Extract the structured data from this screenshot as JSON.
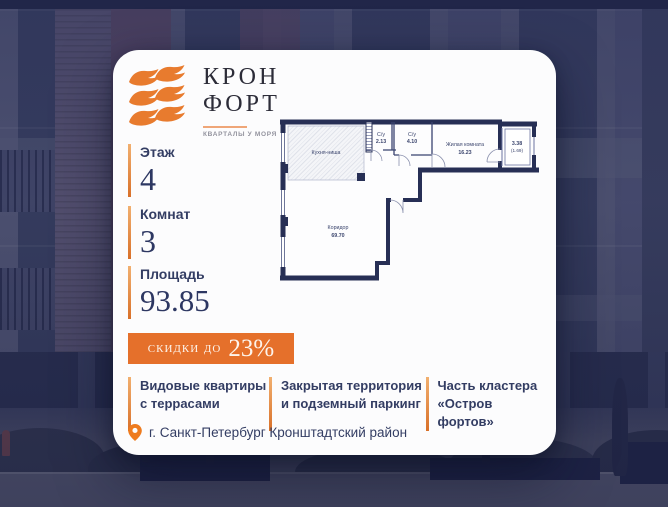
{
  "logo": {
    "title_line1": "КРОН",
    "title_line2": "ФОРТ",
    "subtitle": "КВАРТАЛЫ У МОРЯ",
    "icon": "waves-logo-icon"
  },
  "stats": [
    {
      "label": "Этаж",
      "value": "4"
    },
    {
      "label": "Комнат",
      "value": "3"
    },
    {
      "label": "Площадь",
      "value": "93.85"
    }
  ],
  "discount": {
    "prefix": "скидки до",
    "value": "23%"
  },
  "features": [
    {
      "line1": "Видовые квартиры",
      "line2": "с террасами"
    },
    {
      "line1": "Закрытая территория",
      "line2": "и подземный паркинг"
    },
    {
      "line1": "Часть кластера",
      "line2": "«Остров фортов»"
    }
  ],
  "location": {
    "icon": "map-pin-icon",
    "text": "г. Санкт-Петербург Кронштадтский район"
  },
  "plan": {
    "kitchen_name": "Кухня-ниша",
    "wc1_name": "С/у",
    "wc1_area": "2.13",
    "wc2_name": "С/у",
    "wc2_area": "4.10",
    "living_name": "Жилая комната",
    "living_area": "16.23",
    "corridor_name": "Коридор",
    "corridor_area": "69.70",
    "balcony_area": "3.38",
    "balcony_area_reduced": "(1.69)"
  },
  "colors": {
    "accent_orange": "#e5702b",
    "navy_text": "#333d63",
    "plan_wall": "#272f55",
    "card_bg": "#fcfcfd",
    "bg_tint": "#43486c"
  }
}
